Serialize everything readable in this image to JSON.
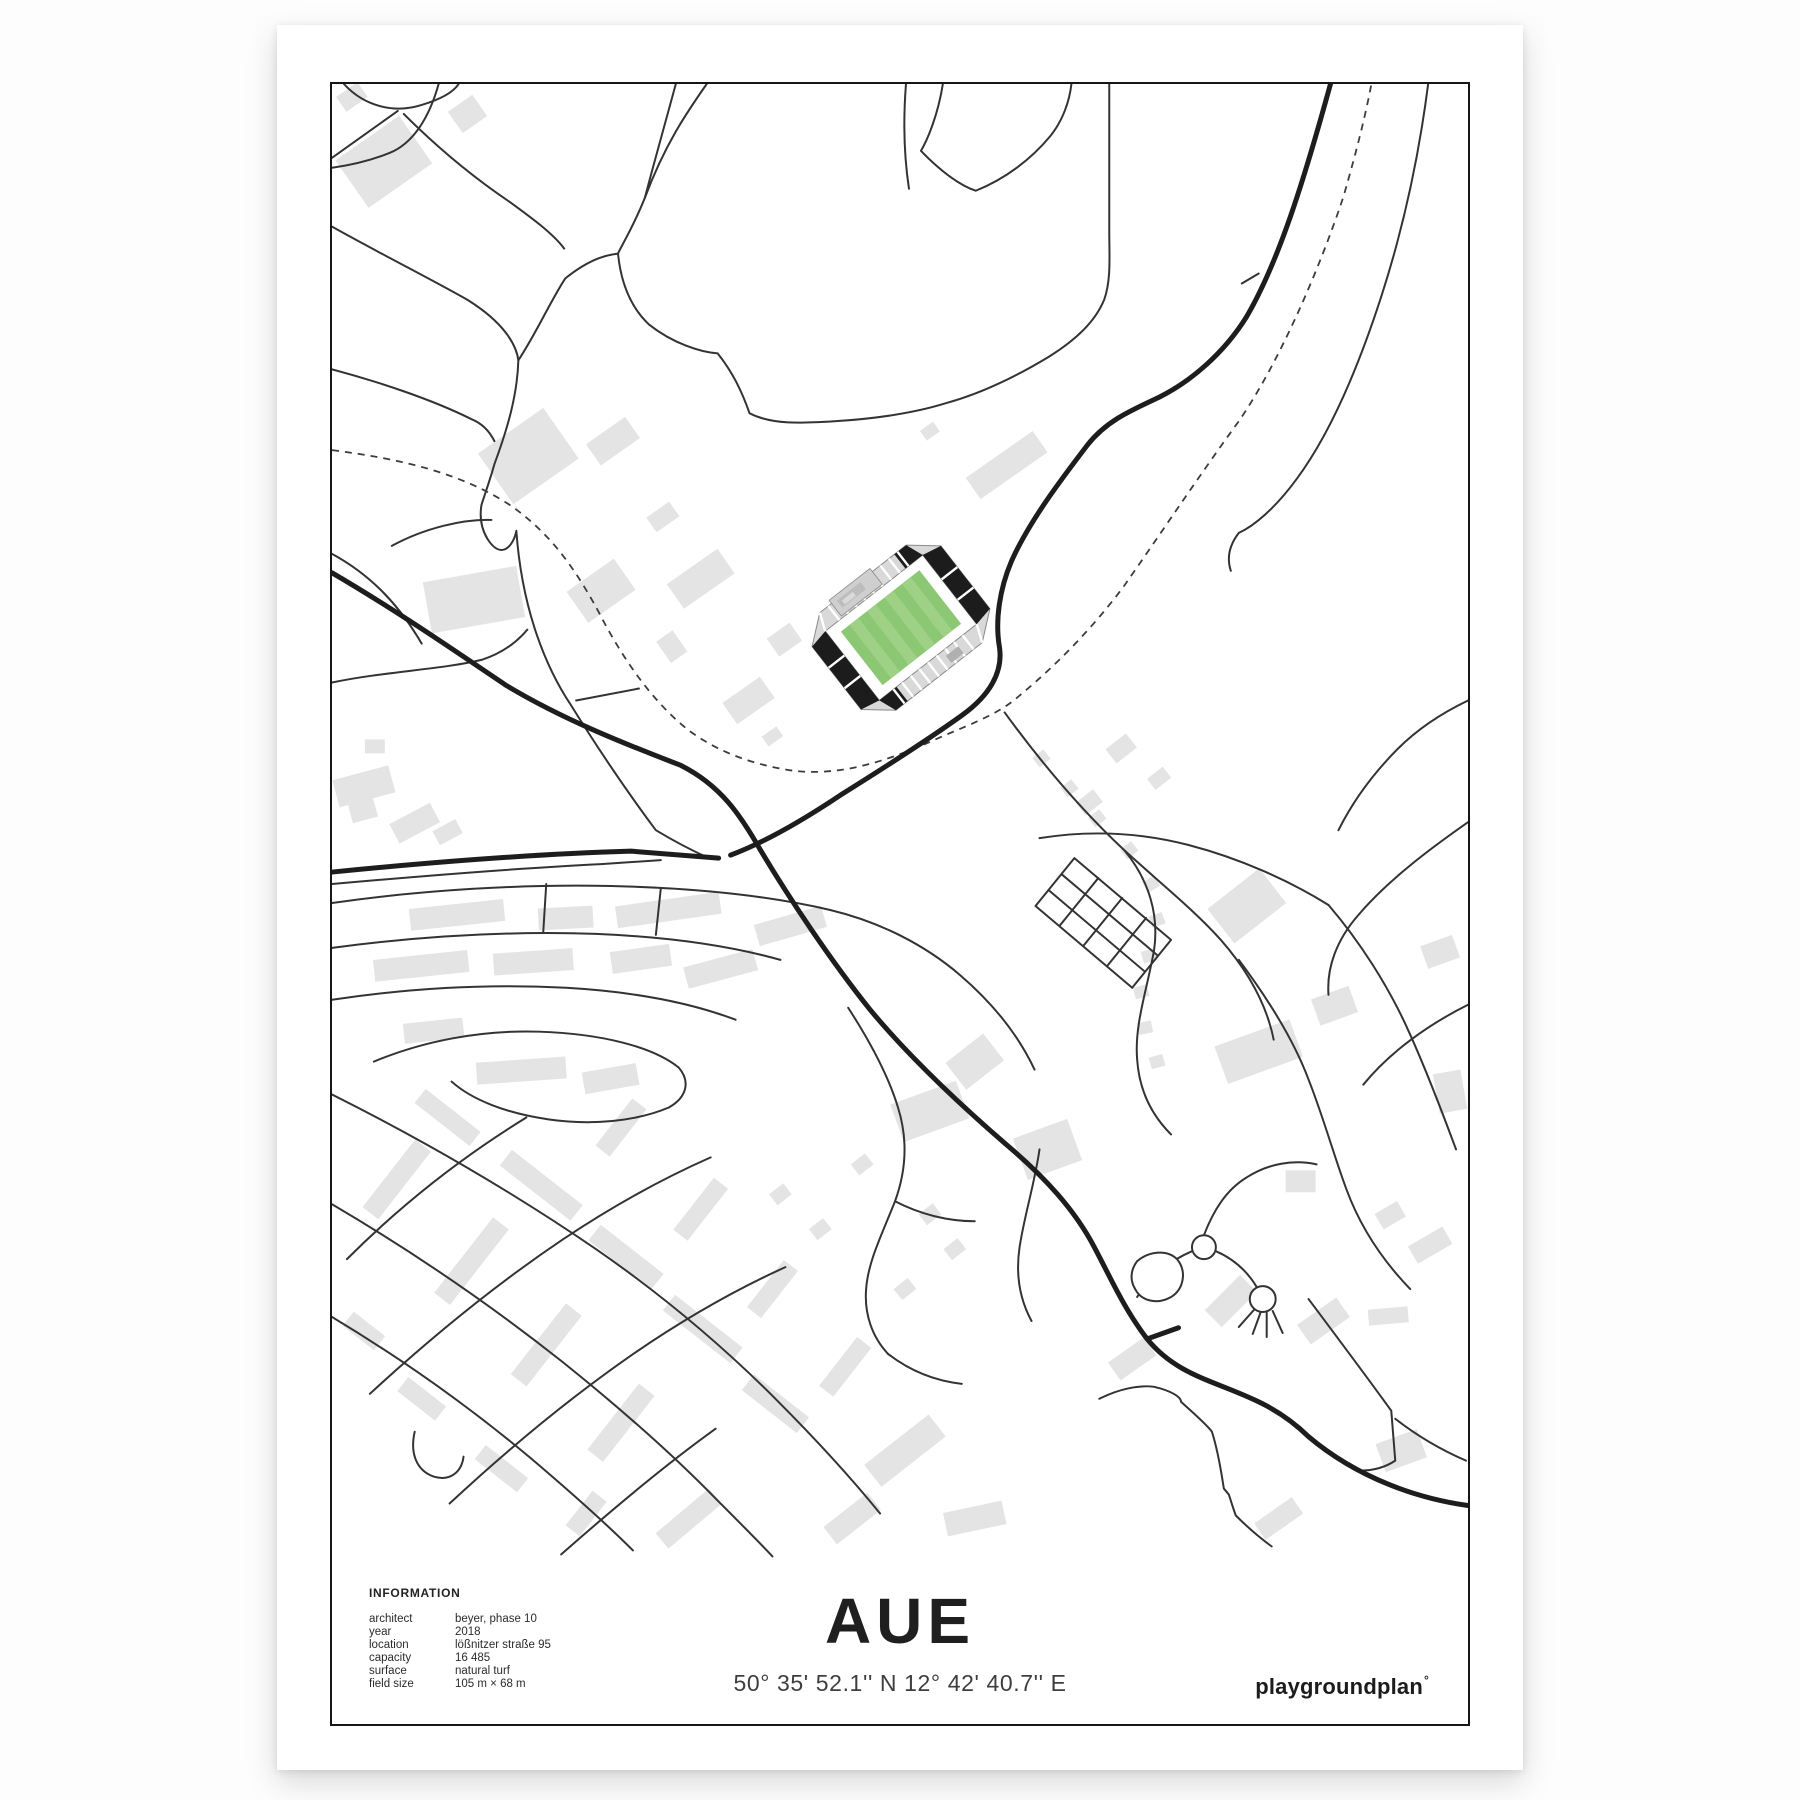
{
  "poster": {
    "title": "AUE",
    "coordinates": "50° 35' 52.1'' N  12° 42' 40.7'' E",
    "brand": {
      "name": "playgroundplan",
      "mark": "°"
    },
    "information": {
      "heading": "INFORMATION",
      "rows": [
        {
          "label": "architect",
          "value": "beyer, phase 10"
        },
        {
          "label": "year",
          "value": "2018"
        },
        {
          "label": "location",
          "value": "lößnitzer straße 95"
        },
        {
          "label": "capacity",
          "value": "16 485"
        },
        {
          "label": "surface",
          "value": "natural turf"
        },
        {
          "label": "field size",
          "value": "105 m × 68 m"
        }
      ]
    },
    "map": {
      "colors": {
        "background": "#ffffff",
        "minor_road": "#333333",
        "main_road": "#1d1d1d",
        "footpath_dashed": "#3c3c3c",
        "building": "#e4e4e4",
        "stand": "#d9d9d9",
        "end_stand": "#1c1c1c",
        "pitch_dark": "#8cc873",
        "pitch_light": "#9ed186"
      }
    }
  }
}
